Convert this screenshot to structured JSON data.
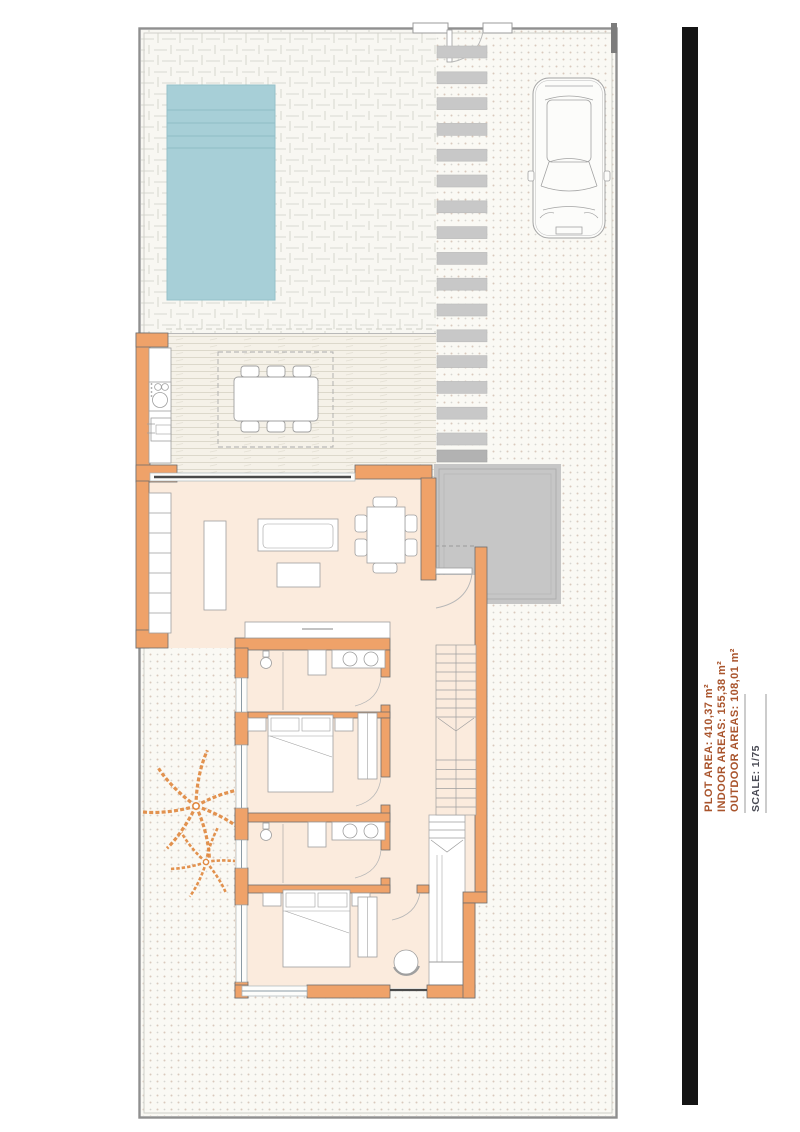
{
  "title_block": {
    "plot_area": "PLOT AREA: 410,37 m²",
    "indoor_areas": "INDOOR AREAS: 155,38 m²",
    "outdoor_areas": "OUTDOOR AREAS: 108,01 m²",
    "scale": "SCALE: 1/75"
  },
  "colors": {
    "area_text": "#A9542C",
    "scale_text": "#4A4B55",
    "wall": "#EFA269",
    "floor": "#FBEBDD",
    "pool": "#A7CFD7",
    "pool_steps": "#8FBCC6",
    "porch": "#C6C6C6",
    "stepping_stone": "#C8C8C8",
    "deck_background": "#F5F1E8",
    "palm": "#E0873E",
    "glass_line": "#4A4A4A",
    "side_bar": "#141414",
    "boundary": "#8F8F8F"
  },
  "features": [
    "plot-boundary",
    "pedestrian-gate",
    "stepping-stone-path",
    "swimming-pool",
    "parked-car",
    "outdoor-kitchen",
    "outdoor-dining-table",
    "pergola",
    "wood-deck-terrace",
    "sliding-glass-door",
    "living-room",
    "shelving-unit",
    "tv-sideboard",
    "sofa",
    "coffee-table",
    "indoor-dining-table",
    "entrance-porch",
    "entrance-door",
    "staircase",
    "under-stair-stairs",
    "hallway",
    "bathroom-1",
    "bathroom-2",
    "bedroom-1",
    "bedroom-2",
    "double-bed",
    "wardrobe",
    "round-chair",
    "palm-trees",
    "garden-gravel",
    "title-block"
  ]
}
